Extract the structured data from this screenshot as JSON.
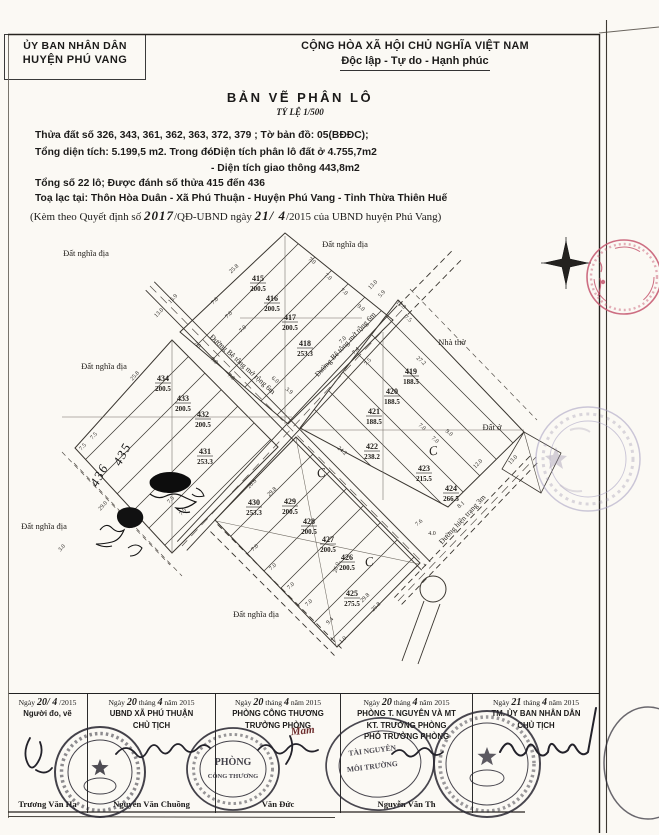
{
  "header": {
    "left1": "ỦY BAN NHÂN DÂN",
    "left2": "HUYỆN PHÚ VANG",
    "right1": "CỘNG HÒA XÃ HỘI CHỦ NGHĨA VIỆT NAM",
    "right2": "Độc lập - Tự do - Hạnh phúc",
    "title": "BẢN VẼ PHÂN LÔ",
    "scale": "TỶ LỆ 1/500"
  },
  "info": {
    "l1": "Thửa đất số 326, 343, 361, 362, 363, 372, 379 ; Tờ bản đồ: 05(BĐĐC);",
    "l2a": "Tổng diện tích: 5.199,5 m2. Trong đó:",
    "l2b": "- Diện tích phân lô đất ở 4.755,7m2",
    "l2c": "- Diện tích giao thông 443,8m2",
    "l3": "Tổng số 22 lô; Được đánh số thửa 415 đến 436",
    "l4": "Toạ lạc tại: Thôn Hòa Duân - Xã Phú Thuận - Huyện Phú Vang - Tỉnh Thừa Thiên Huế",
    "l5_pre": "(Kèm theo Quyết định số",
    "l5_hw1": "2017",
    "l5_mid": "/QĐ-UBND ngày",
    "l5_hw2": "21/ 4",
    "l5_post": "/2015 của UBND huyện Phú Vang)"
  },
  "map": {
    "lots": [
      {
        "n": "415",
        "a": "200.5",
        "x": 258,
        "y": 281
      },
      {
        "n": "416",
        "a": "200.5",
        "x": 272,
        "y": 301
      },
      {
        "n": "417",
        "a": "200.5",
        "x": 290,
        "y": 320
      },
      {
        "n": "418",
        "a": "253.3",
        "x": 305,
        "y": 346
      },
      {
        "n": "419",
        "a": "188.5",
        "x": 411,
        "y": 374
      },
      {
        "n": "420",
        "a": "188.5",
        "x": 392,
        "y": 394
      },
      {
        "n": "421",
        "a": "188.5",
        "x": 374,
        "y": 414
      },
      {
        "n": "422",
        "a": "238.2",
        "x": 372,
        "y": 449
      },
      {
        "n": "423",
        "a": "215.5",
        "x": 424,
        "y": 471
      },
      {
        "n": "424",
        "a": "266.5",
        "x": 451,
        "y": 491
      },
      {
        "n": "425",
        "a": "275.5",
        "x": 352,
        "y": 596
      },
      {
        "n": "426",
        "a": "200.5",
        "x": 347,
        "y": 560
      },
      {
        "n": "427",
        "a": "200.5",
        "x": 328,
        "y": 542
      },
      {
        "n": "428",
        "a": "200.5",
        "x": 309,
        "y": 524
      },
      {
        "n": "429",
        "a": "200.5",
        "x": 290,
        "y": 504
      },
      {
        "n": "430",
        "a": "253.3",
        "x": 254,
        "y": 505
      },
      {
        "n": "431",
        "a": "253.3",
        "x": 205,
        "y": 454
      },
      {
        "n": "432",
        "a": "200.5",
        "x": 203,
        "y": 417
      },
      {
        "n": "433",
        "a": "200.5",
        "x": 183,
        "y": 401
      },
      {
        "n": "434",
        "a": "200.5",
        "x": 163,
        "y": 381
      }
    ],
    "handwritten_lots": [
      {
        "t": "435",
        "x": 126,
        "y": 456,
        "r": -62
      },
      {
        "t": "436",
        "x": 103,
        "y": 477,
        "r": -62
      }
    ],
    "labels": [
      {
        "t": "Đất nghĩa địa",
        "x": 86,
        "y": 256
      },
      {
        "t": "Đất nghĩa địa",
        "x": 345,
        "y": 247
      },
      {
        "t": "Đất nghĩa địa",
        "x": 104,
        "y": 369
      },
      {
        "t": "Đất nghĩa địa",
        "x": 44,
        "y": 529
      },
      {
        "t": "Đất nghĩa địa",
        "x": 256,
        "y": 617
      },
      {
        "t": "Nhà thờ",
        "x": 452,
        "y": 345
      },
      {
        "t": "Đất ở",
        "x": 492,
        "y": 430
      }
    ],
    "road_labels": [
      {
        "t": "Đường Bê tông mở rộng 6m",
        "x": 241,
        "y": 366,
        "r": 42
      },
      {
        "t": "Đường Bê tông mở rộng 6m",
        "x": 347,
        "y": 346,
        "r": -47
      },
      {
        "t": "Đường hiện trạng 3m",
        "x": 464,
        "y": 521,
        "r": -47
      }
    ],
    "dims": [
      {
        "t": "13.0",
        "x": 160,
        "y": 314,
        "r": -46
      },
      {
        "t": "15.9",
        "x": 174,
        "y": 300,
        "r": -46
      },
      {
        "t": "25.8",
        "x": 235,
        "y": 270,
        "r": -42
      },
      {
        "t": "7.0",
        "x": 216,
        "y": 302,
        "r": -46
      },
      {
        "t": "7.0",
        "x": 230,
        "y": 316,
        "r": -46
      },
      {
        "t": "7.0",
        "x": 244,
        "y": 330,
        "r": -46
      },
      {
        "t": "7.0",
        "x": 311,
        "y": 262,
        "r": 38
      },
      {
        "t": "7.0",
        "x": 327,
        "y": 278,
        "r": 38
      },
      {
        "t": "7.0",
        "x": 343,
        "y": 293,
        "r": 38
      },
      {
        "t": "9.0",
        "x": 360,
        "y": 309,
        "r": 38
      },
      {
        "t": "13.0",
        "x": 374,
        "y": 286,
        "r": -46
      },
      {
        "t": "5.9",
        "x": 383,
        "y": 295,
        "r": -46
      },
      {
        "t": "12.0",
        "x": 400,
        "y": 306,
        "r": 38
      },
      {
        "t": "7.5",
        "x": 407,
        "y": 320,
        "r": 38
      },
      {
        "t": "27.2",
        "x": 420,
        "y": 362,
        "r": 40
      },
      {
        "t": "7.0",
        "x": 344,
        "y": 341,
        "r": -46
      },
      {
        "t": "7.4",
        "x": 357,
        "y": 352,
        "r": -46
      },
      {
        "t": "7.5",
        "x": 369,
        "y": 363,
        "r": -46
      },
      {
        "t": "24.2",
        "x": 341,
        "y": 452,
        "r": 40
      },
      {
        "t": "7.0",
        "x": 421,
        "y": 428,
        "r": 40
      },
      {
        "t": "7.0",
        "x": 434,
        "y": 441,
        "r": 40
      },
      {
        "t": "9.0",
        "x": 448,
        "y": 434,
        "r": 40
      },
      {
        "t": "12.0",
        "x": 479,
        "y": 465,
        "r": -46
      },
      {
        "t": "13.0",
        "x": 514,
        "y": 461,
        "r": -46
      },
      {
        "t": "7.0",
        "x": 196,
        "y": 346,
        "r": 40
      },
      {
        "t": "7.0",
        "x": 213,
        "y": 362,
        "r": 40
      },
      {
        "t": "7.0",
        "x": 230,
        "y": 378,
        "r": 40
      },
      {
        "t": "6.0",
        "x": 274,
        "y": 381,
        "r": 40
      },
      {
        "t": "3.9",
        "x": 288,
        "y": 392,
        "r": 40
      },
      {
        "t": "25.8",
        "x": 136,
        "y": 377,
        "r": -48
      },
      {
        "t": "7.5",
        "x": 95,
        "y": 437,
        "r": -48
      },
      {
        "t": "7.5",
        "x": 84,
        "y": 448,
        "r": -48
      },
      {
        "t": "29.0",
        "x": 104,
        "y": 507,
        "r": -48
      },
      {
        "t": "7.5",
        "x": 172,
        "y": 501,
        "r": -48
      },
      {
        "t": "7.5",
        "x": 184,
        "y": 513,
        "r": -48
      },
      {
        "t": "3.0",
        "x": 63,
        "y": 549,
        "r": -48
      },
      {
        "t": "26.6",
        "x": 253,
        "y": 485,
        "r": -44
      },
      {
        "t": "29.8",
        "x": 273,
        "y": 493,
        "r": -44
      },
      {
        "t": "26.0",
        "x": 338,
        "y": 568,
        "r": -72
      },
      {
        "t": "7.0",
        "x": 256,
        "y": 549,
        "r": -44
      },
      {
        "t": "7.0",
        "x": 274,
        "y": 568,
        "r": -44
      },
      {
        "t": "7.0",
        "x": 292,
        "y": 587,
        "r": -44
      },
      {
        "t": "7.0",
        "x": 310,
        "y": 604,
        "r": -44
      },
      {
        "t": "9.4",
        "x": 331,
        "y": 622,
        "r": -44
      },
      {
        "t": "1.0",
        "x": 344,
        "y": 641,
        "r": -44
      },
      {
        "t": "29.8",
        "x": 366,
        "y": 599,
        "r": -44
      },
      {
        "t": "25.8",
        "x": 377,
        "y": 608,
        "r": -44
      },
      {
        "t": "7.6",
        "x": 420,
        "y": 524,
        "r": -40
      },
      {
        "t": "4.0",
        "x": 432,
        "y": 535,
        "r": 0
      },
      {
        "t": "8.1",
        "x": 462,
        "y": 506,
        "r": -40
      }
    ],
    "check_marks": [
      {
        "t": "C",
        "x": 322,
        "y": 477
      },
      {
        "t": "C",
        "x": 434,
        "y": 455
      },
      {
        "t": "C",
        "x": 370,
        "y": 566
      }
    ]
  },
  "stamps": {
    "phong": "PHÒNG",
    "cong_thuong": "CÔNG THƯƠNG",
    "tai_nguyen": "TÀI NGUYÊN",
    "moi_truong": "MÔI TRƯỜNG",
    "mam": "Mam"
  },
  "signatures": {
    "columns": [
      {
        "date": [
          {
            "t": "Ngày ",
            "h": 0
          },
          {
            "t": "20/ 4",
            "h": 1
          },
          {
            "t": " /2015",
            "h": 0
          }
        ],
        "lines": [
          "Người đo, vẽ"
        ],
        "name": "Trương Văn Hạ"
      },
      {
        "date": [
          {
            "t": "Ngày ",
            "h": 0
          },
          {
            "t": "20",
            "h": 1
          },
          {
            "t": " tháng ",
            "h": 0
          },
          {
            "t": "4",
            "h": 1
          },
          {
            "t": " năm 2015",
            "h": 0
          }
        ],
        "lines": [
          "UBND XÃ PHÚ THUẬN",
          "CHỦ TỊCH"
        ],
        "name": "Nguyễn Văn Chuồng"
      },
      {
        "date": [
          {
            "t": "Ngày ",
            "h": 0
          },
          {
            "t": "20",
            "h": 1
          },
          {
            "t": " tháng ",
            "h": 0
          },
          {
            "t": "4",
            "h": 1
          },
          {
            "t": " năm 2015",
            "h": 0
          }
        ],
        "lines": [
          "PHÒNG CÔNG THƯƠNG",
          "TRƯỞNG PHÒNG"
        ],
        "name": "Văn Đức"
      },
      {
        "date": [
          {
            "t": "Ngày ",
            "h": 0
          },
          {
            "t": "20",
            "h": 1
          },
          {
            "t": " tháng ",
            "h": 0
          },
          {
            "t": "4",
            "h": 1
          },
          {
            "t": " năm 2015",
            "h": 0
          }
        ],
        "lines": [
          "PHÒNG T. NGUYÊN VÀ MT",
          "KT. TRƯỞNG PHÒNG",
          "PHÓ TRƯỞNG PHÒNG"
        ],
        "name": "Nguyễn Văn Th"
      },
      {
        "date": [
          {
            "t": "Ngày ",
            "h": 0
          },
          {
            "t": "21",
            "h": 1
          },
          {
            "t": " tháng ",
            "h": 0
          },
          {
            "t": "4",
            "h": 1
          },
          {
            "t": " năm 2015",
            "h": 0
          }
        ],
        "lines": [
          "TM. ỦY BAN NHÂN DÂN",
          "CHỦ TỊCH"
        ],
        "name": ""
      }
    ]
  }
}
